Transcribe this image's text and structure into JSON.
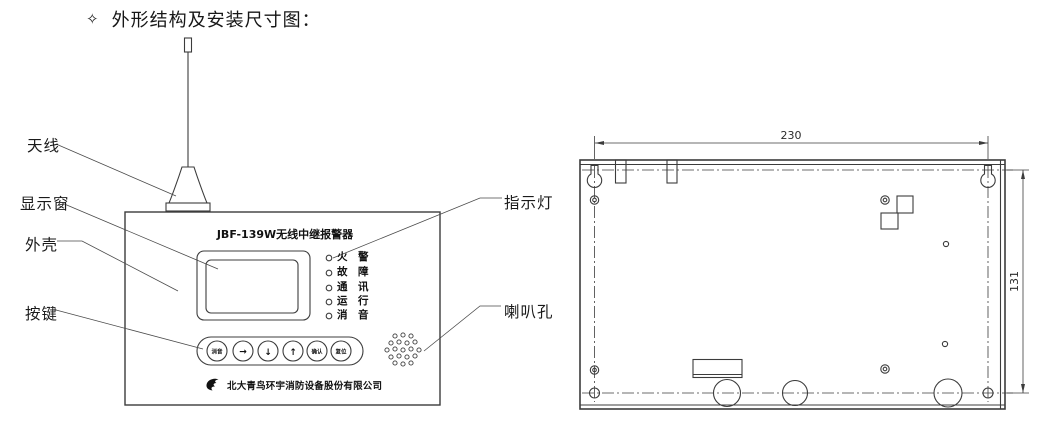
{
  "header": {
    "bullet_icon": "✧",
    "title": "外形结构及安装尺寸图："
  },
  "front_view": {
    "panel_title": "JBF-139W无线中继报警器",
    "callouts": {
      "antenna": "天线",
      "display_window": "显示窗",
      "housing": "外壳",
      "keys": "按键",
      "indicator_lights": "指示灯",
      "speaker_holes": "喇叭孔"
    },
    "led_labels": [
      "火　警",
      "故　障",
      "通　讯",
      "运　行",
      "消　音"
    ],
    "buttons": [
      "消音",
      "→",
      "↓",
      "↑",
      "确认",
      "复位"
    ],
    "company": "北大青鸟环宇消防设备股份有限公司"
  },
  "back_view": {
    "dim_width": "230",
    "dim_height": "131"
  },
  "colors": {
    "line": "#3c3c3c",
    "text": "#1a1a1a"
  }
}
